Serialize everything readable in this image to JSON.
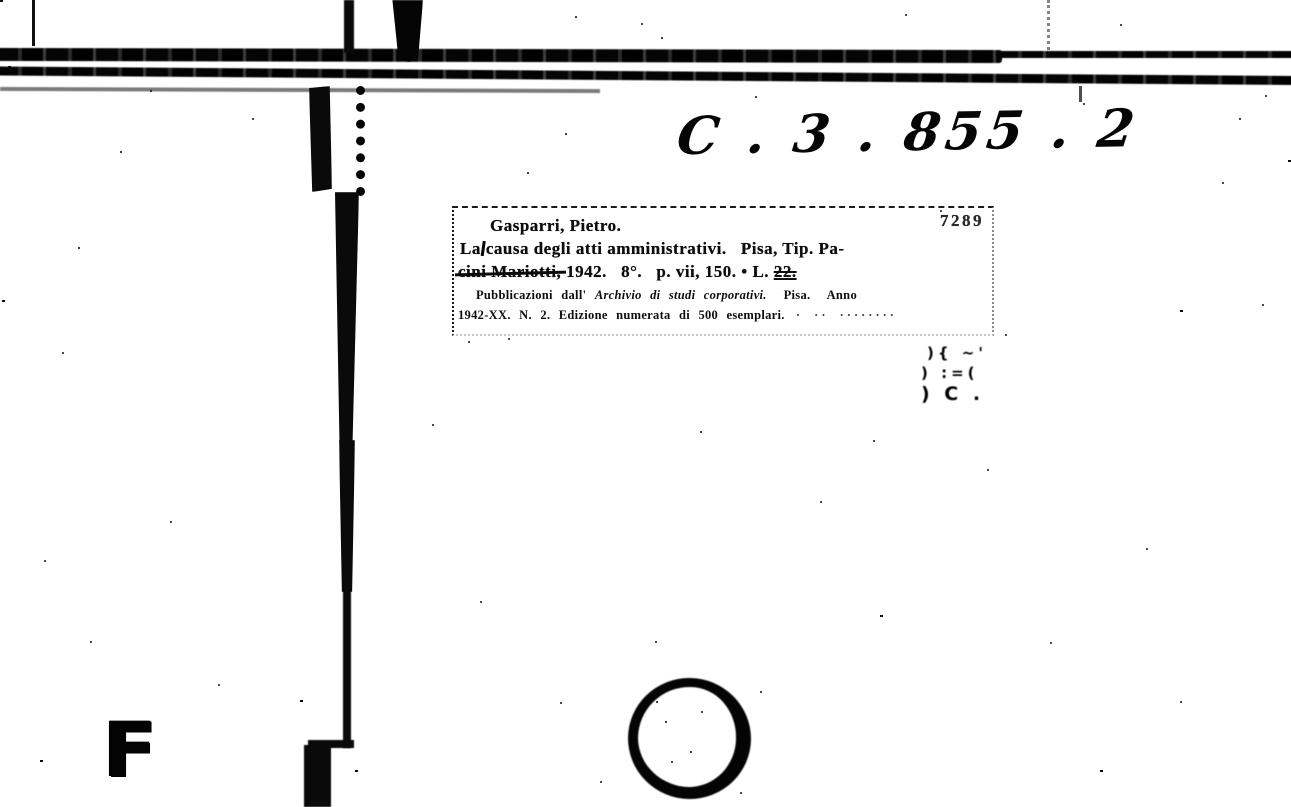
{
  "document": {
    "call_number": "C . 3 . 855 . 2",
    "card": {
      "control_number": "7289",
      "heading": "Gasparri, Pietro.",
      "line1_start": "La",
      "line1_rest": "causa degli atti amministrativi.   Pisa, Tip. Pa-",
      "line2_struck": "cini Mariotti,",
      "line2_mid": " 1942.   8°.   p. vii, 150. • L. ",
      "line2_price": "22.",
      "note1_prefix": "Pubblicazioni dall' ",
      "note1_series": "Archivio di studi corporativi.",
      "note1_suffix": "  Pisa.  Anno",
      "note2": "1942-XX. N. 2. Edizione numerata di 500 esemplari.",
      "note2_trailing": " · ·· ········"
    },
    "marks": {
      "corner_letter": "F",
      "stamp_rows": [
        "){ ~'",
        ") :=(",
        ") C ."
      ]
    }
  }
}
